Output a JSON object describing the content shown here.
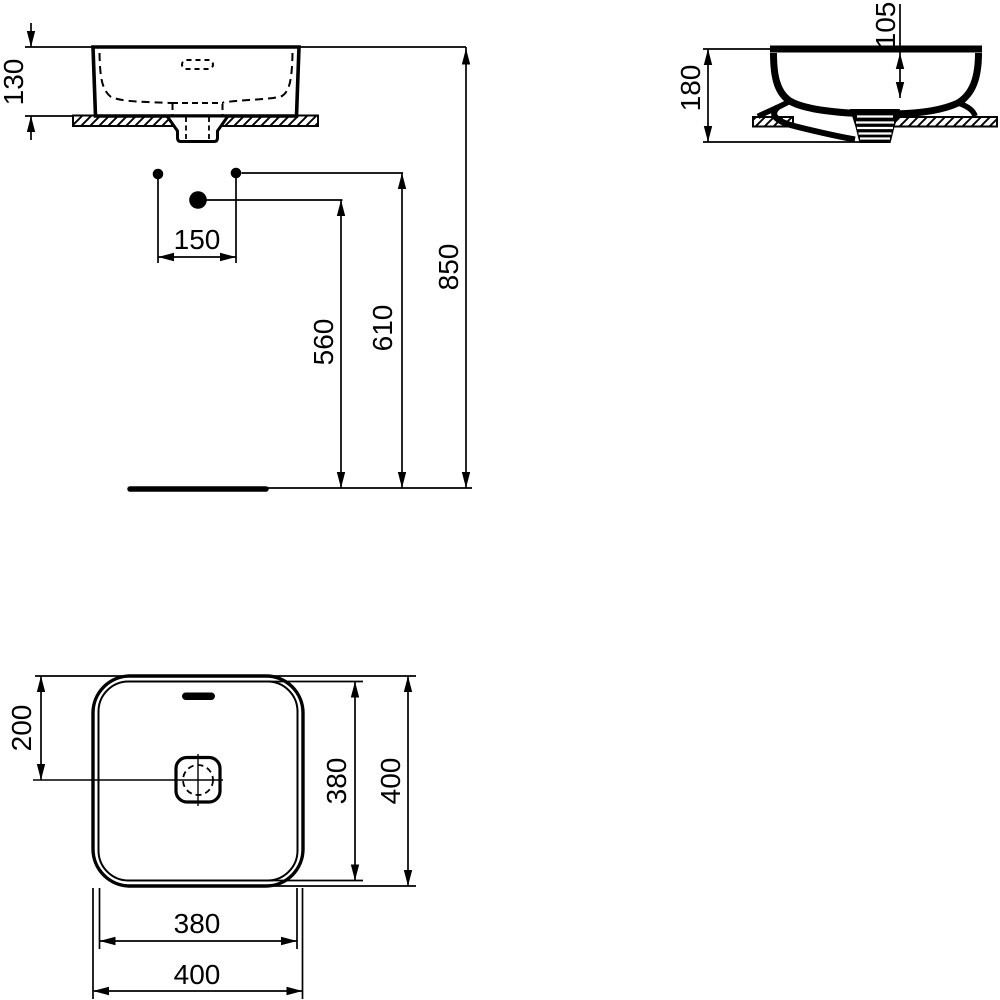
{
  "views": {
    "front": {
      "height_above_counter": "130",
      "tap_hole_spacing": "150",
      "trap_height": "560",
      "inlet_height": "610",
      "rim_height": "850"
    },
    "side": {
      "overall_height": "180",
      "inner_depth": "105"
    },
    "plan": {
      "center_offset": "200",
      "inner_width": "380",
      "outer_width": "400",
      "inner_depth": "380",
      "outer_depth": "400"
    }
  },
  "colors": {
    "line": "#000000",
    "background": "#ffffff"
  }
}
